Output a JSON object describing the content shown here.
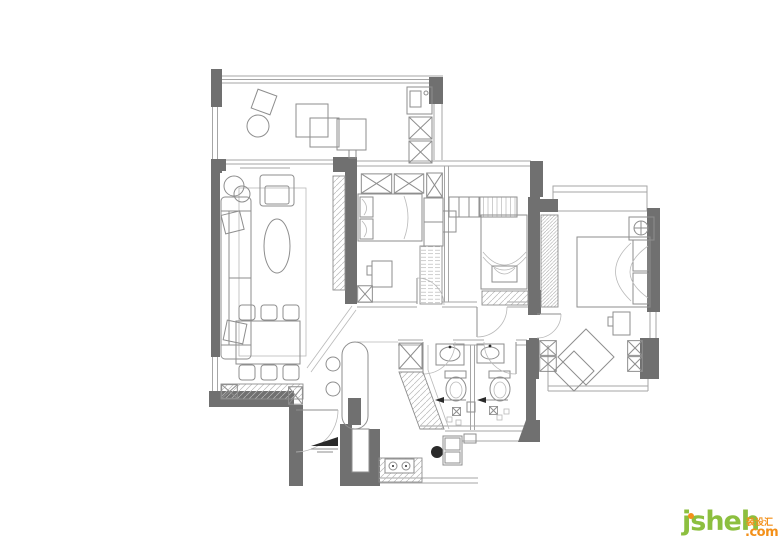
{
  "watermark": {
    "brand": "jsheh",
    "cjk": "装设汇",
    "tld": ".com"
  },
  "colors": {
    "bg": "#ffffff",
    "wall": "#707070",
    "ink": "#2a2a2a",
    "line": "#8e8e8e",
    "lineLight": "#b9b9b9",
    "window": "#a6a6a6",
    "brandGreen": "#8cbf3f",
    "brandOrange": "#f39019"
  }
}
